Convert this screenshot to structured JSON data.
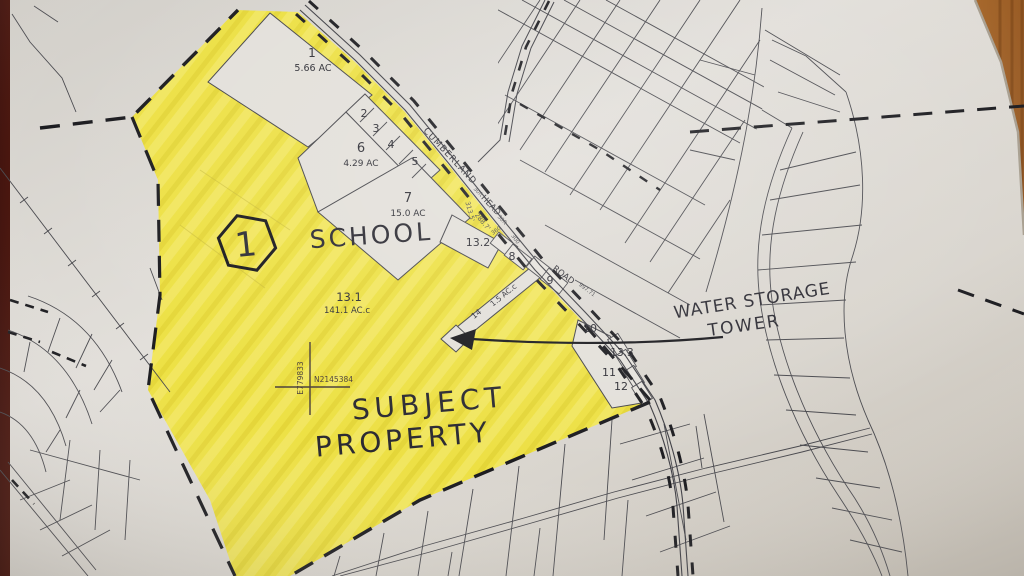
{
  "map_index_badge": "1",
  "handwritten": {
    "school": "SCHOOL",
    "subject_line1": "SUBJECT",
    "subject_line2": "PROPERTY",
    "water_line1": "WATER STORAGE",
    "water_line2": "TOWER"
  },
  "parcels": {
    "p1": {
      "id": "1",
      "area": "5.66 AC"
    },
    "p2": {
      "id": "2"
    },
    "p3": {
      "id": "3"
    },
    "p4": {
      "id": "4"
    },
    "p5": {
      "id": "5"
    },
    "p6": {
      "id": "6",
      "area": "4.29 AC"
    },
    "p7": {
      "id": "7",
      "area": "15.0 AC"
    },
    "p8": {
      "id": "8"
    },
    "p9": {
      "id": "9"
    },
    "p10": {
      "id": "10"
    },
    "p11": {
      "id": "11"
    },
    "p12": {
      "id": "12"
    },
    "p13_1": {
      "id": "13.1",
      "area": "141.1 AC.c"
    },
    "p13_2": {
      "id": "13.2"
    },
    "p13_3": {
      "id": "13.3"
    },
    "p14": {
      "id": "14",
      "area": "1.5 AC.c"
    }
  },
  "roads": {
    "name_upper": "CUMBERLAND",
    "name_lower": "HEAD",
    "road_word": "ROAD",
    "frontage": "997.71",
    "width_note": "30ft"
  },
  "dimensions": {
    "d1": "313.5'",
    "d2": "288.7'",
    "d3": "360",
    "d4": "300"
  },
  "survey_cross": {
    "easting": "E779833",
    "northing": "N2145384"
  },
  "colors": {
    "highlight_yellow": "#efe23c",
    "paper": "#dcd9d3",
    "ink": "#46464b",
    "handwriting_ink": "#2b2a32",
    "boundary_dash": "#1c1c20",
    "wood_dark": "#4a140c",
    "wood_light": "#a96f37"
  }
}
